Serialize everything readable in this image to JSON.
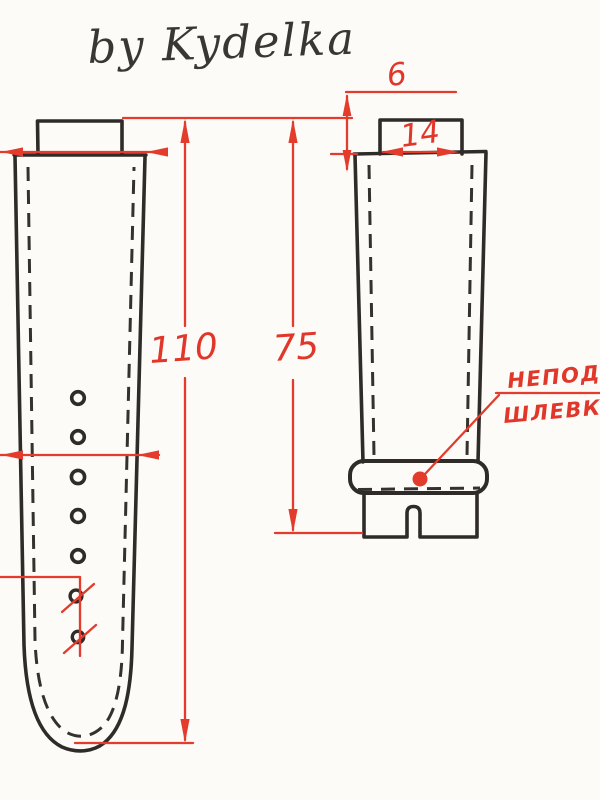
{
  "meta": {
    "description": "Scanned hand-drawn technical sketch of a two-piece watch strap pattern with red dimension annotations",
    "paper_color": "#fcfbf8",
    "ink_color": "#2f2b28",
    "annotation_color": "#e33b2c"
  },
  "title": {
    "text": "by Kydelka"
  },
  "dimensions": {
    "tab_height": {
      "label": "6"
    },
    "tab_width": {
      "label": "14"
    },
    "long_strap_length": {
      "label": "110"
    },
    "short_strap_length": {
      "label": "75"
    }
  },
  "callout": {
    "line1": "НЕПОДВИ",
    "line2": "ШЛЕВКА"
  },
  "left_strap": {
    "hole_count_total": 7,
    "crossed_out_holes": 2,
    "end_shape": "rounded"
  },
  "right_strap": {
    "has_fixed_keeper": true,
    "notched_buckle_end": true
  }
}
